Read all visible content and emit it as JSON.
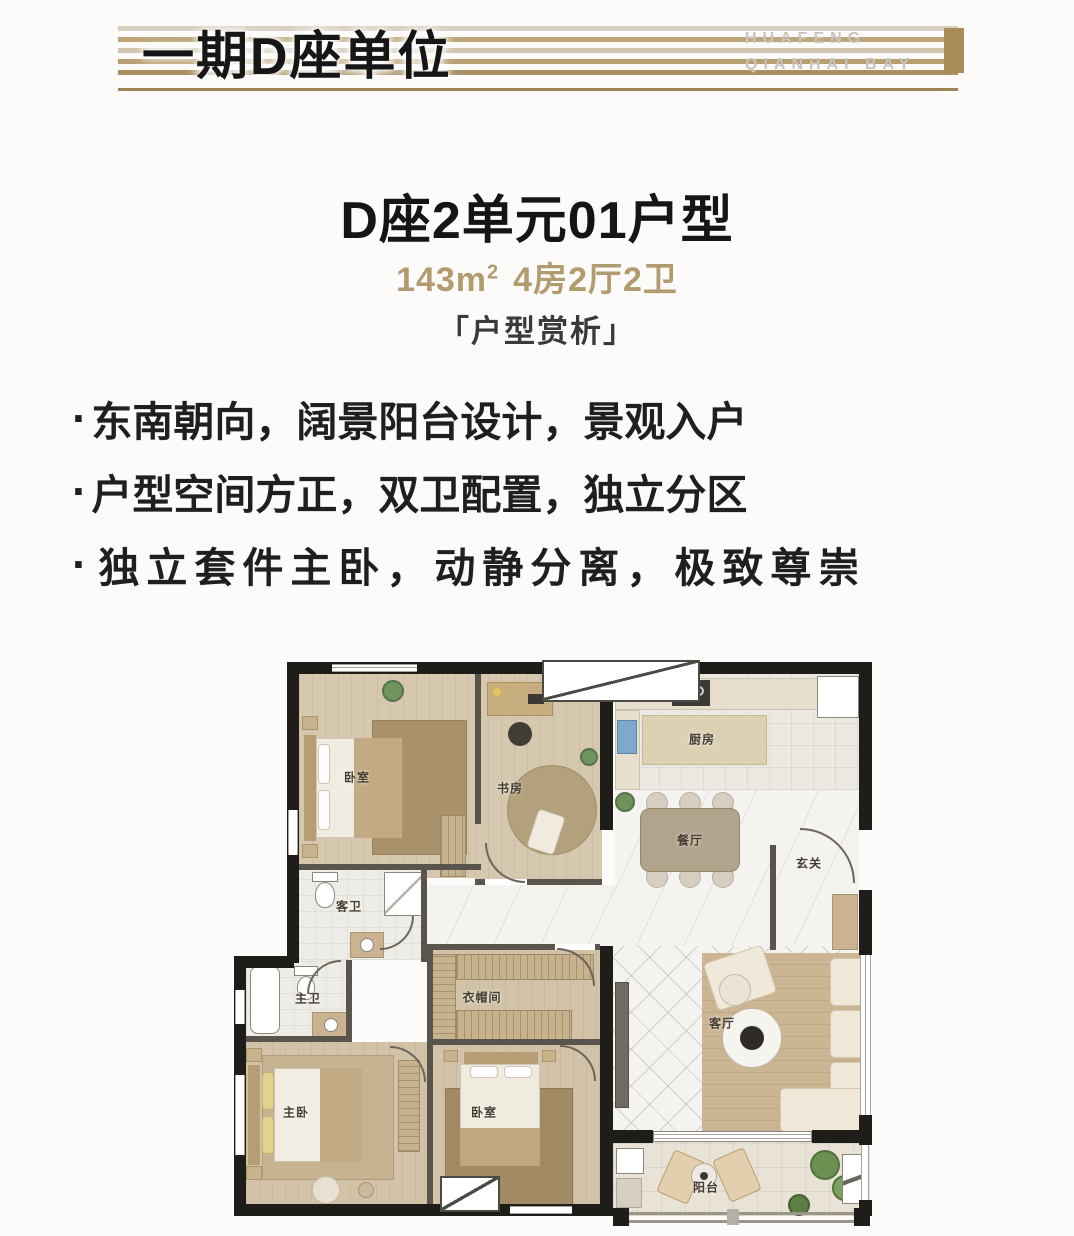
{
  "header": {
    "title": "一期D座单位",
    "brand": {
      "line1": "HUAFENG",
      "line2": "QIANHAI BAY"
    },
    "accent_color": "#ab8d58"
  },
  "unit": {
    "title": "D座2单元01户型",
    "area": "143m",
    "area_exp": "2",
    "layout": "4房2厅2卫",
    "tag": "「户型赏析」",
    "subtitle_color": "#b19b6f"
  },
  "features": {
    "bullet": "·",
    "items": [
      "东南朝向，阔景阳台设计，景观入户",
      "户型空间方正，双卫配置，独立分区",
      "独立套件主卧，动静分离，极致尊崇"
    ]
  },
  "floorplan": {
    "rooms": {
      "bedroom_top": "卧室",
      "study": "书房",
      "kitchen": "厨房",
      "dining": "餐厅",
      "entry": "玄关",
      "guest_bath": "客卫",
      "master_bath": "主卫",
      "closet": "衣帽间",
      "master_bedroom": "主卧",
      "bedroom_bottom": "卧室",
      "living": "客厅",
      "balcony": "阳台"
    }
  }
}
